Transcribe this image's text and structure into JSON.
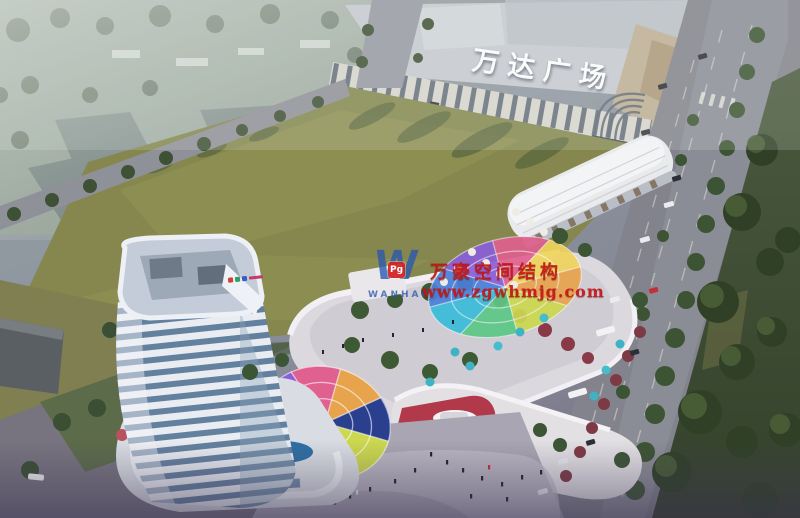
{
  "scene_title": "aerial architectural rendering of mixed-use development beside Wanda Plaza",
  "signs": {
    "mall_roof_sign": "万达广场"
  },
  "watermark": {
    "logo_letter": "W",
    "logo_badge": "Pg",
    "logo_name": "WANHAO",
    "line1": "万豪空间结构",
    "line2": "www.zgwhmjg.com",
    "red": "#c41414",
    "blue": "#2b57b0",
    "badge_red": "#d42020"
  },
  "palette": {
    "haze": "#9aa69b",
    "lawn_field": "#85874e",
    "field_shadow": "#46563a",
    "road": "#82838c",
    "mall_roof": "#c6cad1",
    "mall_wing_tan": "#bfae94",
    "tower_white": "#e9edf2",
    "tower_glass": "#64809f",
    "retail_white": "#e3e0e4",
    "retail_red_accent": "#b2394a",
    "umbrella_teal": "#3fb3c4",
    "green_strip": "#3a4a30",
    "dome_colors": [
      "#8a5fd8",
      "#4a7fd9",
      "#3bbcd9",
      "#5cc785",
      "#ccd94f",
      "#e8a34d",
      "#e0608f",
      "#6a4fc0"
    ]
  }
}
